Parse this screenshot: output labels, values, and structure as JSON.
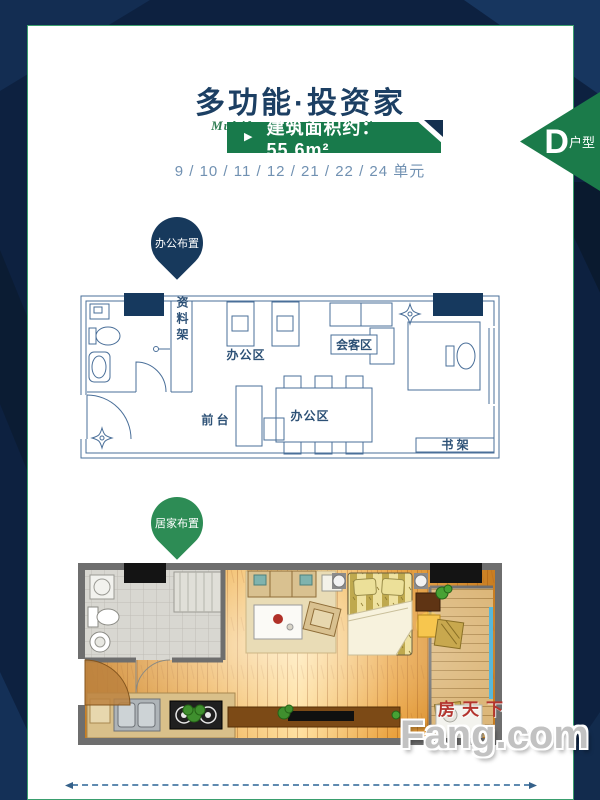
{
  "colors": {
    "background_navy": "#0d2140",
    "accent_green": "#1b7b4a",
    "banner_green": "#187a4b",
    "title_blue": "#1c3f63",
    "plan_line_blue": "#4a6f99",
    "column_navy": "#16395e",
    "units_blue": "#7191b2",
    "watermark_red": "#b3342e"
  },
  "header": {
    "title": "多功能·投资家",
    "subtitle": "Multifunctional • capitalists"
  },
  "area_banner": {
    "bullet_icon": "▶",
    "text": "建筑面积约：55.6m²"
  },
  "units_line": "9 / 10 / 11 / 12 / 21 / 22 / 24 单元",
  "type_ribbon": {
    "letter": "D",
    "suffix": "户型"
  },
  "office_plan": {
    "pin_label": "办公布置",
    "labels": {
      "files_shelf": "资料架",
      "office_area_top": "办公区",
      "meeting_area": "会客区",
      "front_desk": "前 台",
      "office_area_bottom": "办公区",
      "bookshelf": "书 架"
    }
  },
  "home_plan": {
    "pin_label": "居家布置"
  },
  "watermark": {
    "cn": "房天下",
    "en": "Fang.com"
  }
}
